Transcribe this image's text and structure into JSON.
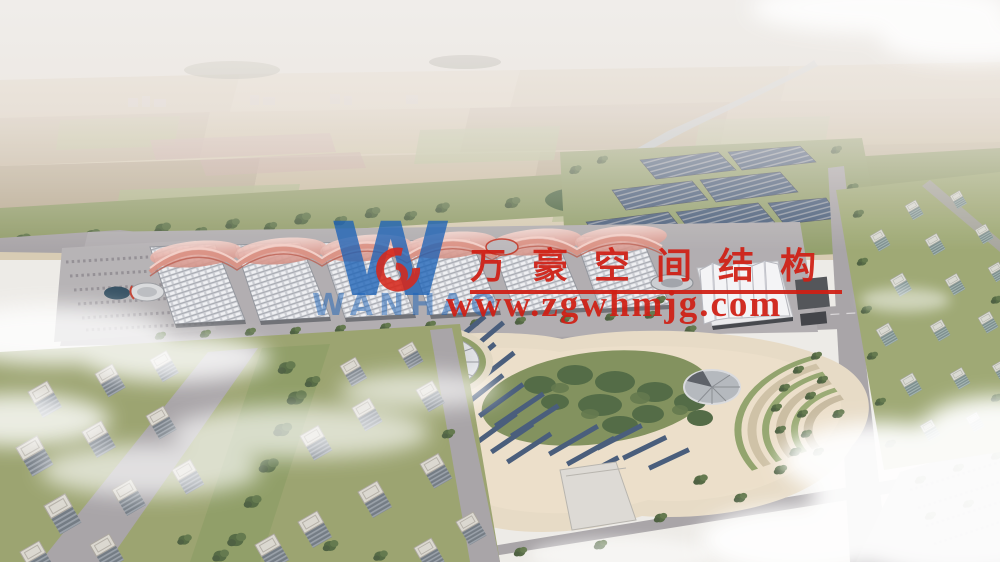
{
  "watermark": {
    "company_name": "万豪空间结构",
    "website": "www.zgwhmjg.com",
    "logo_letter": "W",
    "logo_subtext": "WANHAO",
    "red": "#d01f14",
    "blue": "#1d63b7"
  },
  "scene": {
    "palette": {
      "sky": "#eceae7",
      "farmland": "#d6cab1",
      "greenery": "#8e9a66",
      "road": "#a5a1a5",
      "hall_roof": "#d8d9dd",
      "canopy": "#e3a79e",
      "solar_panel": "#415677",
      "plaza": "#e6dac5",
      "cloud": "#ffffff"
    }
  }
}
